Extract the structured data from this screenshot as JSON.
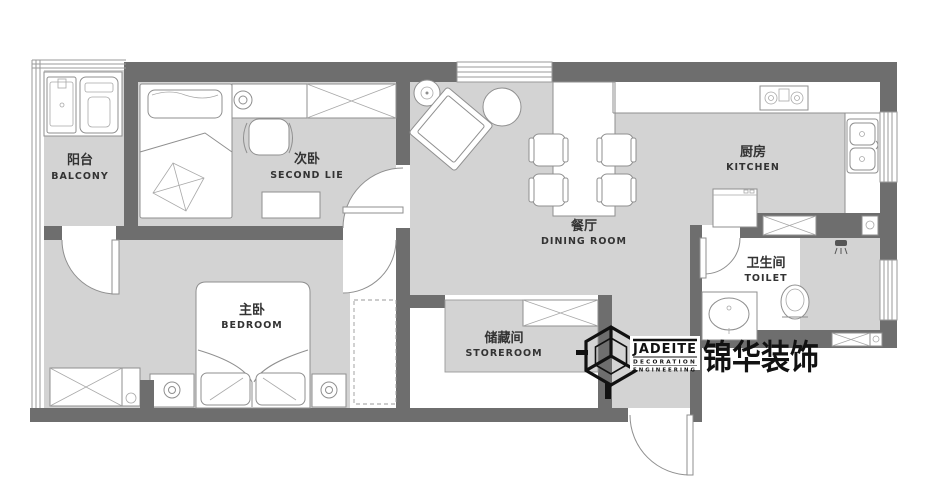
{
  "title": "apartment floor plan",
  "rooms": {
    "balcony": {
      "zh": "阳台",
      "en": "BALCONY"
    },
    "second_bedroom": {
      "zh": "次卧",
      "en": "SECOND LIE"
    },
    "dining_room": {
      "zh": "餐厅",
      "en": "DINING ROOM"
    },
    "kitchen": {
      "zh": "厨房",
      "en": "KITCHEN"
    },
    "master_bedroom": {
      "zh": "主卧",
      "en": "BEDROOM"
    },
    "storeroom": {
      "zh": "储藏间",
      "en": "STOREROOM"
    },
    "toilet": {
      "zh": "卫生间",
      "en": "TOILET"
    }
  },
  "logo": {
    "brand": "JADEITE",
    "sub_line1": "DECORATION",
    "sub_line2": "ENGINEERING",
    "brand_cn": "锦华装饰"
  },
  "colors": {
    "wall": "#6e6e6e",
    "floor": "#d3d3d3",
    "furniture_outline": "#8f8f8f",
    "label": "#333333",
    "logo": "#111111"
  }
}
